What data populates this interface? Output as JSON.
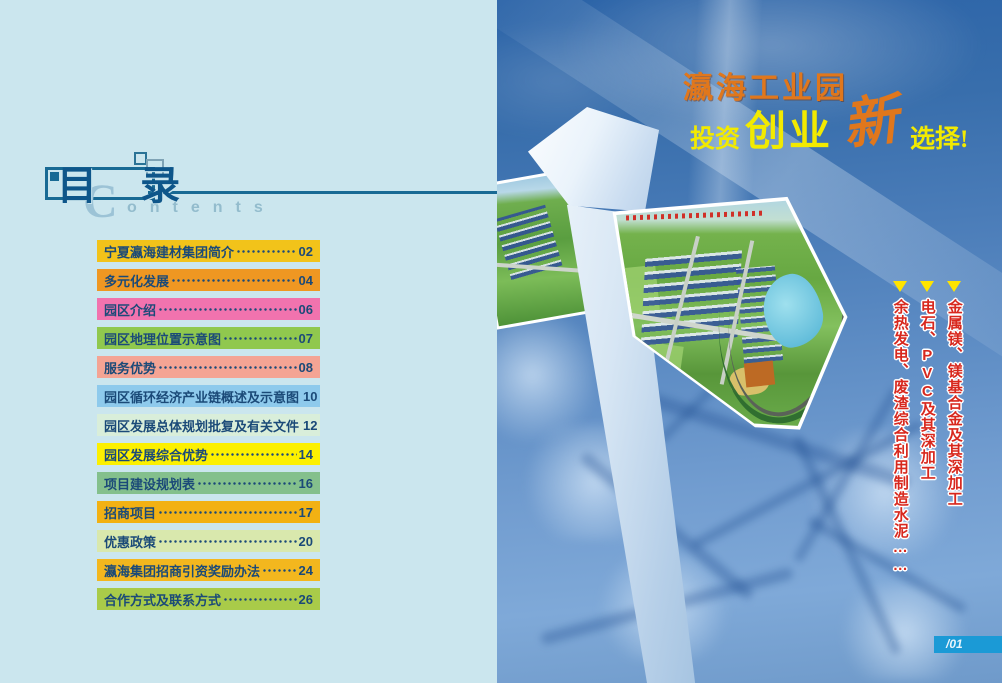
{
  "toc": {
    "title": "目 录",
    "contents_initial": "C",
    "contents_rest": "ontents",
    "text_color": "#1b4a78",
    "items": [
      {
        "label": "宁夏瀛海建材集团简介",
        "page": "02",
        "color": "#f2c31a"
      },
      {
        "label": "多元化发展",
        "page": "04",
        "color": "#ef9722"
      },
      {
        "label": "园区介绍",
        "page": "06",
        "color": "#f173ae"
      },
      {
        "label": "园区地理位置示意图",
        "page": "07",
        "color": "#90c84e"
      },
      {
        "label": "服务优势",
        "page": "08",
        "color": "#f4a494"
      },
      {
        "label": "园区循环经济产业链概述及示意图",
        "page": "10",
        "color": "#8ecaec"
      },
      {
        "label": "园区发展总体规划批复及有关文件",
        "page": "12",
        "color": "#d9eeda"
      },
      {
        "label": "园区发展综合优势",
        "page": "14",
        "color": "#fcf000"
      },
      {
        "label": "项目建设规划表",
        "page": "16",
        "color": "#84c08c"
      },
      {
        "label": "招商项目",
        "page": "17",
        "color": "#f2b113"
      },
      {
        "label": "优惠政策",
        "page": "20",
        "color": "#d9e8ad"
      },
      {
        "label": "瀛海集团招商引资奖励办法",
        "page": "24",
        "color": "#f3b71e"
      },
      {
        "label": "合作方式及联系方式",
        "page": "26",
        "color": "#a9cb49"
      }
    ]
  },
  "hero": {
    "headline_line1": "瀛海工业园",
    "headline_words": {
      "w1": "投资",
      "w2": "创业",
      "w3": "新",
      "w4": "选择!"
    },
    "slogans": [
      {
        "text": "金属镁、镁基合金及其深加工"
      },
      {
        "text": "电石、PVC及其深加工"
      },
      {
        "text": "余热发电、废渣综合利用制造水泥……"
      }
    ],
    "page_number": "/01",
    "colors": {
      "headline_orange": "#e0771c",
      "headline_yellow": "#f2ea00",
      "slogan_red": "#d8281e",
      "arrow_yellow": "#ffe400",
      "badge_blue": "#1b9ad6"
    }
  }
}
